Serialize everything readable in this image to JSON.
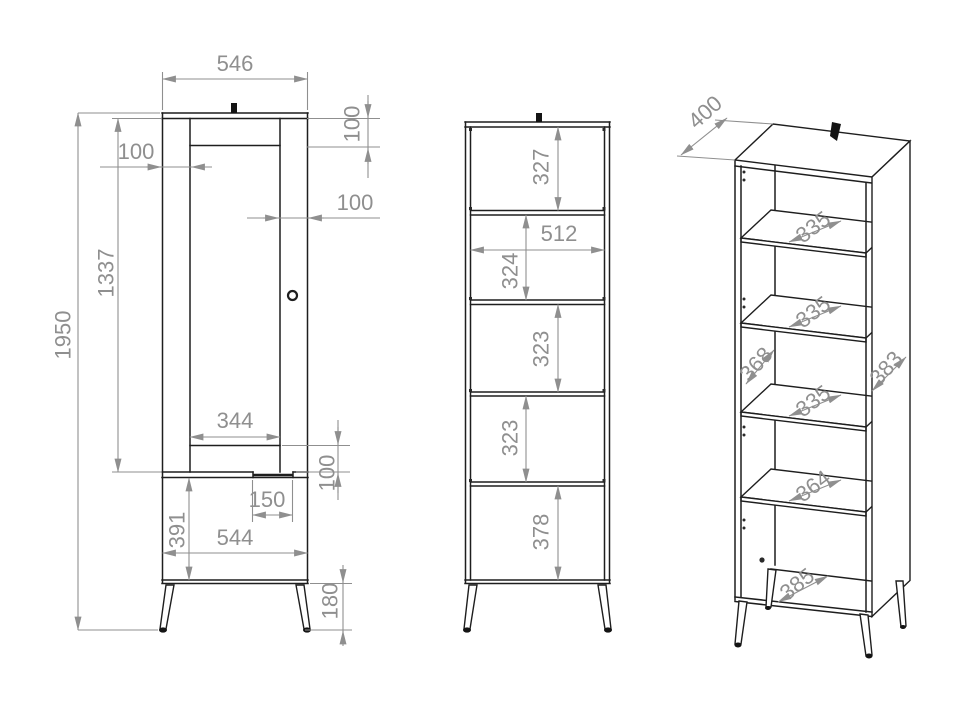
{
  "drawing_type": "furniture-technical-drawing",
  "colors": {
    "outline": "#1e1e1e",
    "dimension": "#8f8f8f",
    "background": "#ffffff"
  },
  "front_view": {
    "dims": {
      "top_width": "546",
      "total_height": "1950",
      "door_height": "1337",
      "left_stile": "100",
      "top_rail": "100",
      "right_stile": "100",
      "door_inner_width": "344",
      "bottom_rail": "100",
      "handle_cutout": "150",
      "base_height": "391",
      "bottom_width": "544",
      "leg_height": "180"
    }
  },
  "open_view": {
    "dims": {
      "top_space": "327",
      "inner_width": "512",
      "space_2": "324",
      "space_3": "323",
      "space_4": "323",
      "bottom_space": "378"
    }
  },
  "iso_view": {
    "dims": {
      "depth": "400",
      "shelf_depth_1": "335",
      "shelf_depth_2": "335",
      "shelf_depth_3": "335",
      "left_inner_depth": "368",
      "right_side_depth": "383",
      "shelf_depth_4": "364",
      "bottom_depth": "385"
    }
  }
}
